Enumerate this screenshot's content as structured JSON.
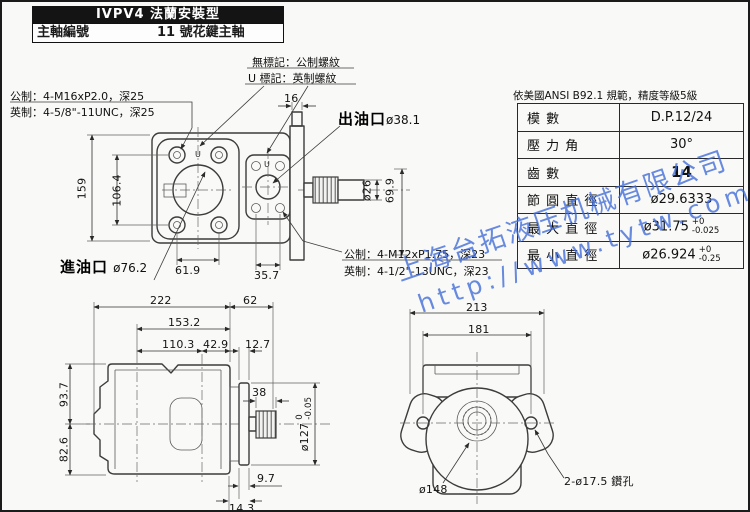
{
  "title_block": {
    "model_line": "IVPV4 法蘭安裝型",
    "spindle_label": "主軸編號",
    "spindle_value": "11 號花鍵主軸"
  },
  "notes": {
    "no_mark": "無標記：公制螺紋",
    "u_mark_note": "U 標記：英制螺紋",
    "top_metric": "公制：4-M16xP2.0，深25",
    "top_imperial": "英制：4-5/8\"-11UNC，深25",
    "bottom_metric": "公制：4-M12xP1.75，深23",
    "bottom_imperial": "英制：4-1/2\"-13UNC，深23"
  },
  "port_labels": {
    "outlet": "出油口",
    "outlet_dia": "ø38.1",
    "inlet": "進油口",
    "inlet_dia": "ø76.2",
    "u_mark": "U"
  },
  "spec_table": {
    "caption": "依美國ANSI B92.1 規範，精度等級5級",
    "rows": [
      {
        "label": "模 數",
        "value": "D.P.12/24"
      },
      {
        "label": "壓 力 角",
        "value": "30°"
      },
      {
        "label": "齒 數",
        "value": "14"
      },
      {
        "label": "節 圓 直 徑",
        "value": "ø29.6333"
      },
      {
        "label": "最 大 直 徑",
        "value": "ø31.75",
        "tol_top": "+0",
        "tol_bot": "-0.025"
      },
      {
        "label": "最 小 直 徑",
        "value": "ø26.924",
        "tol_top": "+0",
        "tol_bot": "-0.25"
      }
    ]
  },
  "watermark": {
    "line1": "上海台拓液压机械有限公司",
    "line2": "http://www.tytw.com",
    "color": "#3f6cd9"
  },
  "dims": {
    "d159": "159",
    "d106_4": "106.4",
    "d61_9": "61.9",
    "d35_7": "35.7",
    "d16": "16",
    "d26": "ø26",
    "d69_9": "69.9",
    "d222": "222",
    "d62": "62",
    "d153_2": "153.2",
    "d110_3": "110.3",
    "d42_9": "42.9",
    "d12_7": "12.7",
    "d38": "38",
    "d127": "ø127",
    "d127_tol_top": "0",
    "d127_tol_bot": "-0.05",
    "d9_7": "9.7",
    "d14_3": "14.3",
    "d93_7": "93.7",
    "d82_6": "82.6",
    "d213": "213",
    "d181": "181",
    "d148": "ø148",
    "drill_note": "2-ø17.5 鑽孔"
  }
}
